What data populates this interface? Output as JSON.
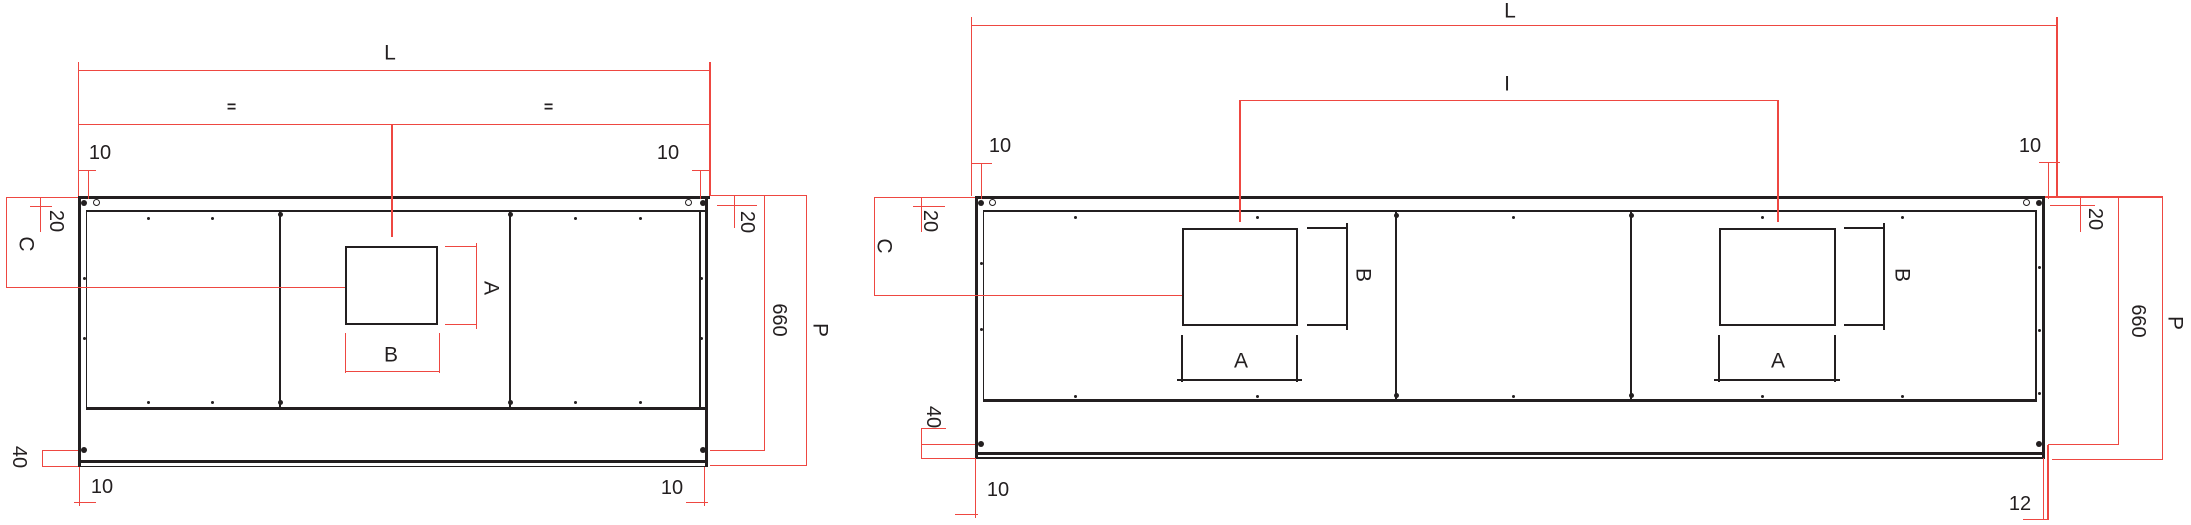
{
  "colors": {
    "dimension_red": "#ee4741",
    "line_black": "#231f20",
    "background": "#ffffff"
  },
  "left_view": {
    "length": "L",
    "equal_left": "=",
    "equal_right": "=",
    "top_offset_left": "10",
    "top_offset_right": "10",
    "top_inset_left": "20",
    "top_inset_right": "20",
    "hole_position": "C",
    "hole_height": "A",
    "hole_width": "B",
    "body_height": "660",
    "overall_height": "P",
    "bottom_inset": "40",
    "bottom_offset_left": "10",
    "bottom_offset_right": "10"
  },
  "right_view": {
    "length": "L",
    "hole_spacing": "I",
    "top_offset_left": "10",
    "top_offset_right": "10",
    "top_inset_left": "20",
    "top_inset_right": "20",
    "hole_position": "C",
    "hole1_height": "B",
    "hole1_width": "A",
    "hole2_height": "B",
    "hole2_width": "A",
    "body_height": "660",
    "overall_height": "P",
    "bottom_inset": "40",
    "bottom_offset_left": "10",
    "bottom_offset_right": "12"
  }
}
